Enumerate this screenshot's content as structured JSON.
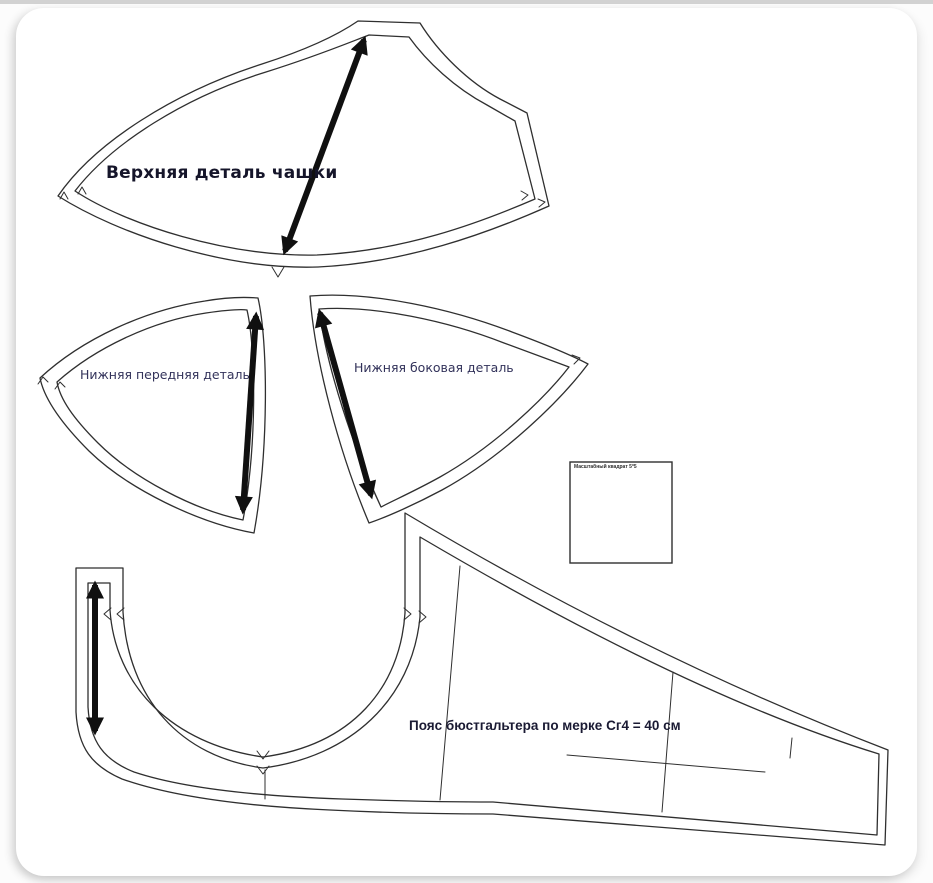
{
  "theme": {
    "top_bar": "#d2d2d2",
    "page_bg": "#fcfcfc",
    "canvas_bg": "#ffffff",
    "line": "#2f2f2f",
    "arrow": "#101010",
    "title_text": "#15152a",
    "label_text": "#32325a",
    "band_text": "#1a1a33"
  },
  "pattern": {
    "labels": {
      "upper_cup": "Верхняя деталь чашки",
      "lower_front": "Нижняя передняя деталь",
      "lower_side": "Нижняя боковая деталь",
      "band": "Пояс бюстгальтера по мерке Сг4 = 40 см",
      "scale_square": "Масштабный квадрат 5*5"
    }
  }
}
